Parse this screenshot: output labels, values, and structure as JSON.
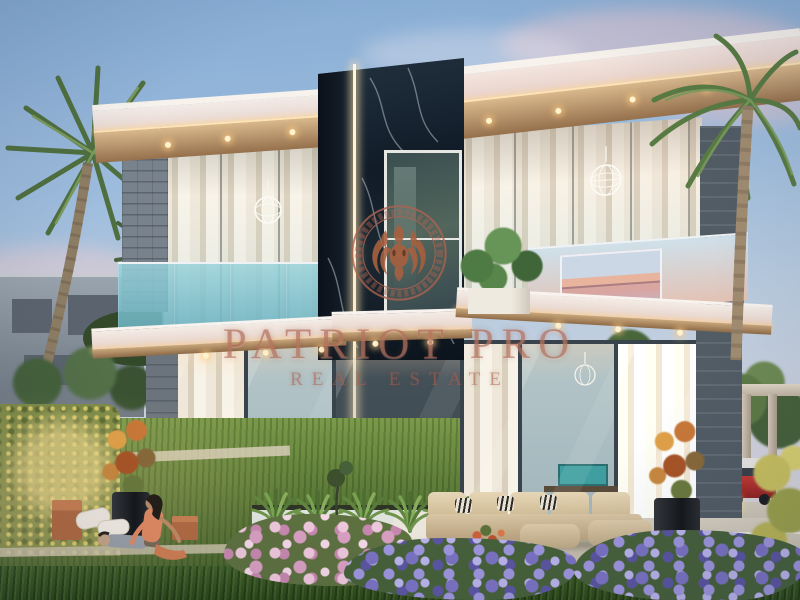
{
  "image": {
    "kind": "dusk architectural rendering of a modern two-storey glass villa with black marble feature wall, palm trees and landscaped garden",
    "width": 800,
    "height": 600
  },
  "watermark": {
    "line1": "PATRIOT PRO",
    "line2": "REAL ESTATE",
    "logo": "lion head emblem inside double ring with greek-key border",
    "color": "#ad6350"
  },
  "palette": {
    "sky_top": "#85abd3",
    "sky_horizon": "#ddd5d8",
    "cloud_pink": "#e8c6cc",
    "marble_wall": "#101b27",
    "roof_white": "#f2eae6",
    "soffit_wood": "#c9a77c",
    "led_warm": "#ffe3b4",
    "balcony_glass_teal": "#76bcc8",
    "sunset_reflection": "#e9b49e",
    "stone_pillar": "#78828c",
    "slate_pillar": "#525c65",
    "lawn_green": "#527032",
    "hedge_green": "#7c8a45",
    "flowers_pink": "#d79ec0",
    "flowers_purple": "#7a72c2",
    "sofa_beige": "#d8c5a4",
    "autumn_plant": "#c87838",
    "car_red": "#b83230",
    "dress_coral": "#e18a62"
  }
}
